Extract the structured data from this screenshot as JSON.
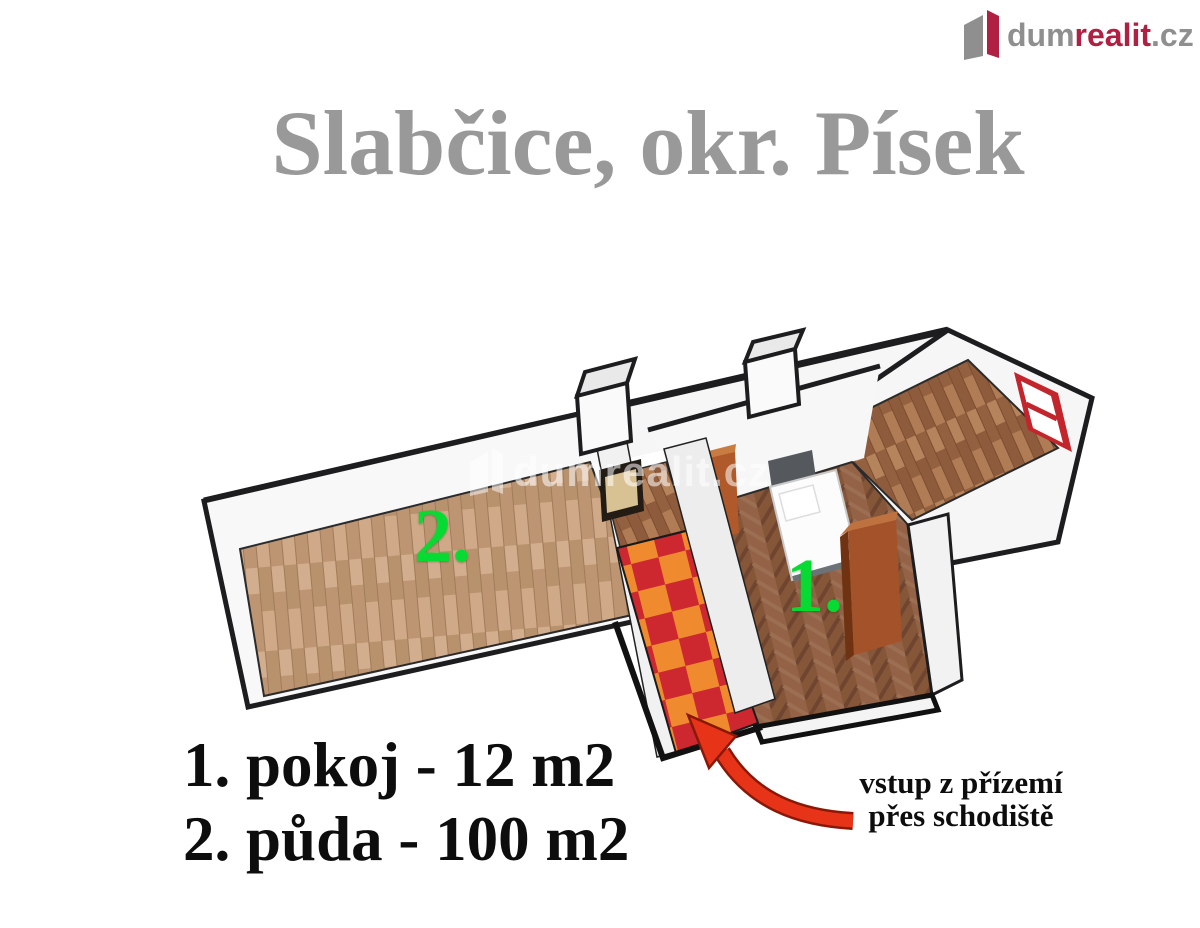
{
  "logo": {
    "brand_gray": "dum",
    "brand_red": "realit",
    "brand_suffix": ".cz"
  },
  "title": "Slabčice, okr. Písek",
  "floorplan": {
    "watermark_text": "dumrealit.cz",
    "room_labels": [
      {
        "number": "1."
      },
      {
        "number": "2."
      }
    ]
  },
  "legend": {
    "items": [
      {
        "text": "1. pokoj - 12 m2"
      },
      {
        "text": "2. půda - 100 m2"
      }
    ]
  },
  "annotation": {
    "line1": "vstup z přízemí",
    "line2": "přes schodiště"
  },
  "colors": {
    "title_gray": "#999999",
    "label_green": "#07DB33",
    "arrow_red": "#E73418",
    "logo_red": "#B02043",
    "logo_gray": "#8F8F8F",
    "checker_red": "#CD2730",
    "checker_orange": "#EF8B2E",
    "wood_light": "#C6A17E",
    "wood_herringbone": "#8B5C40",
    "wood_mid": "#A5714A",
    "outline_black": "#1D1D1F"
  }
}
